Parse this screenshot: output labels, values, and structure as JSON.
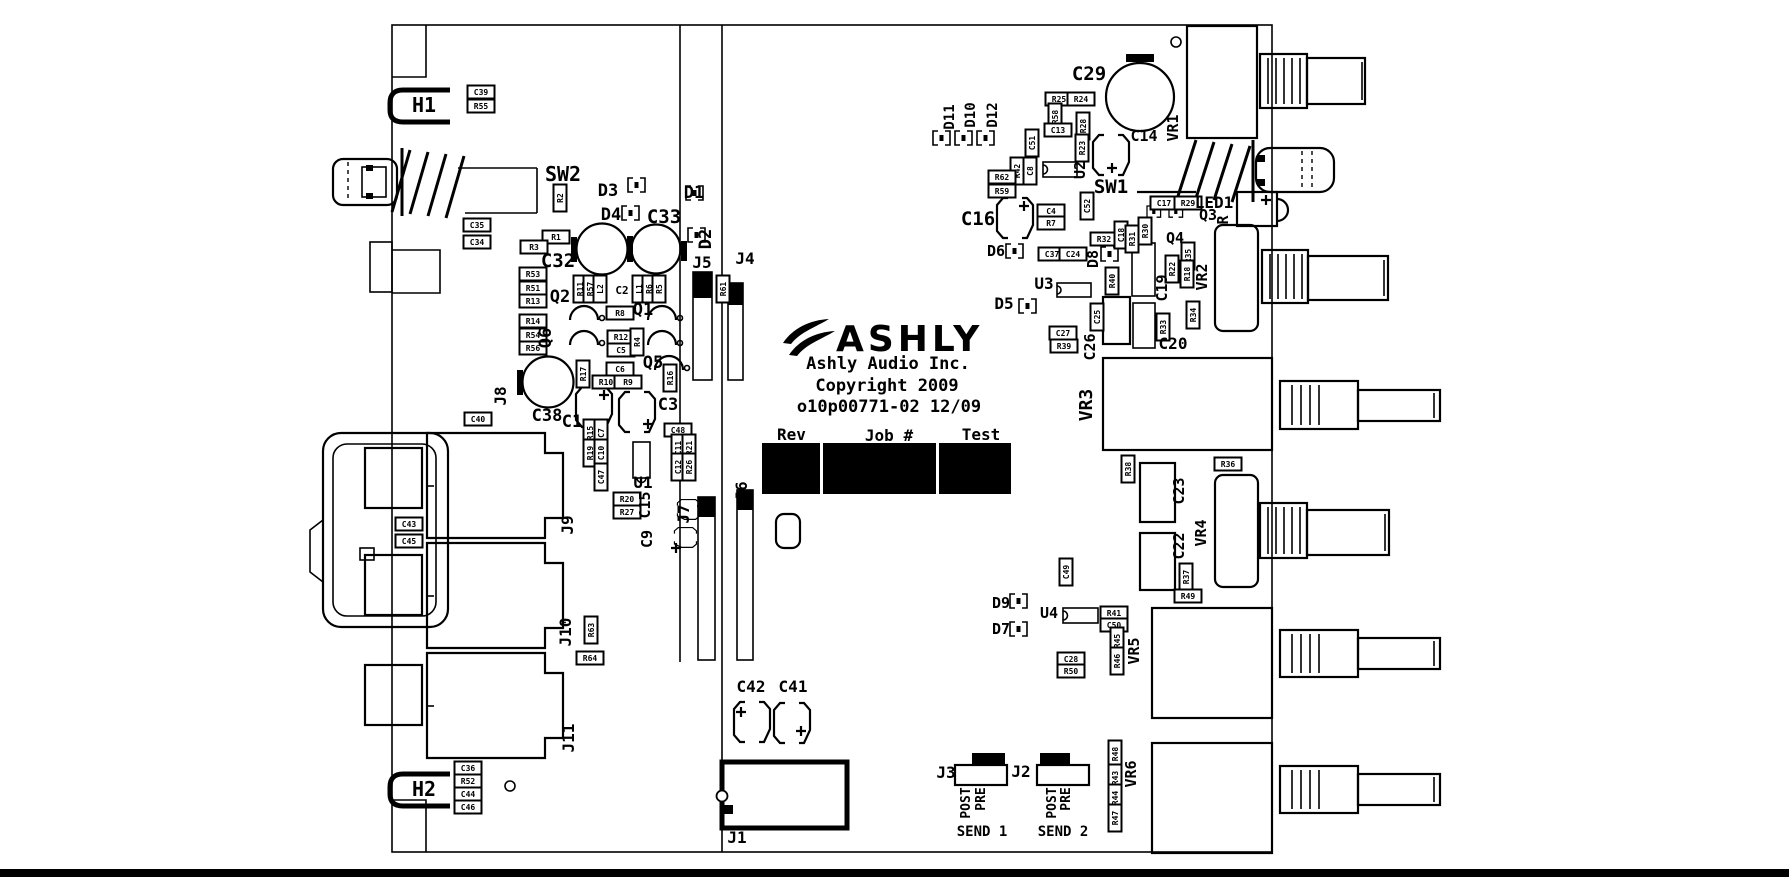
{
  "logo": {
    "brand": "ASHLY",
    "company": "Ashly Audio Inc.",
    "copyright": "Copyright 2009",
    "part_number": "o10p00771-02 12/09"
  },
  "fields": {
    "rev": "Rev",
    "job": "Job #",
    "test": "Test"
  },
  "colors": {
    "silkscreen": "#000000",
    "background": "#ffffff"
  },
  "labels": [
    {
      "t": "H1",
      "x": 424,
      "y": 112,
      "s": 20
    },
    {
      "t": "SW2",
      "x": 563,
      "y": 181,
      "s": 20
    },
    {
      "t": "D3",
      "x": 608,
      "y": 196,
      "s": 17
    },
    {
      "t": "D4",
      "x": 611,
      "y": 220,
      "s": 17
    },
    {
      "t": "C33",
      "x": 664,
      "y": 223,
      "s": 19
    },
    {
      "t": "D1",
      "x": 694,
      "y": 198,
      "s": 17
    },
    {
      "t": "D2",
      "x": 711,
      "y": 239,
      "r": 1,
      "s": 17
    },
    {
      "t": "C32",
      "x": 558,
      "y": 267,
      "s": 19
    },
    {
      "t": "J5",
      "x": 702,
      "y": 268
    },
    {
      "t": "J4",
      "x": 745,
      "y": 264
    },
    {
      "t": "Q2",
      "x": 560,
      "y": 302,
      "s": 17
    },
    {
      "t": "C2",
      "x": 622,
      "y": 294,
      "s": 11
    },
    {
      "t": "Q1",
      "x": 643,
      "y": 315,
      "s": 17
    },
    {
      "t": "Q6",
      "x": 551,
      "y": 338,
      "r": 1,
      "s": 17
    },
    {
      "t": "Q5",
      "x": 653,
      "y": 368,
      "s": 17
    },
    {
      "t": "J8",
      "x": 506,
      "y": 396,
      "r": 1
    },
    {
      "t": "C38",
      "x": 547,
      "y": 421,
      "s": 17
    },
    {
      "t": "C1",
      "x": 572,
      "y": 427,
      "s": 17
    },
    {
      "t": "C3",
      "x": 668,
      "y": 410,
      "s": 17
    },
    {
      "t": "U1",
      "x": 643,
      "y": 488
    },
    {
      "t": "C15",
      "x": 650,
      "y": 505,
      "r": 1,
      "s": 15
    },
    {
      "t": "C9",
      "x": 652,
      "y": 539,
      "r": 1,
      "s": 15
    },
    {
      "t": "J7",
      "x": 689,
      "y": 514,
      "r": 1
    },
    {
      "t": "J6",
      "x": 747,
      "y": 491,
      "r": 1
    },
    {
      "t": "J9",
      "x": 573,
      "y": 525,
      "r": 1
    },
    {
      "t": "J10",
      "x": 571,
      "y": 632,
      "r": 1
    },
    {
      "t": "J11",
      "x": 574,
      "y": 738,
      "r": 1
    },
    {
      "t": "H2",
      "x": 424,
      "y": 796,
      "s": 20
    },
    {
      "t": "C42",
      "x": 751,
      "y": 692
    },
    {
      "t": "C41",
      "x": 793,
      "y": 692
    },
    {
      "t": "J1",
      "x": 737,
      "y": 843
    },
    {
      "t": "D11",
      "x": 954,
      "y": 117,
      "r": 1,
      "s": 14
    },
    {
      "t": "D10",
      "x": 975,
      "y": 115,
      "r": 1,
      "s": 14
    },
    {
      "t": "D12",
      "x": 997,
      "y": 115,
      "r": 1,
      "s": 14
    },
    {
      "t": "C29",
      "x": 1089,
      "y": 80,
      "s": 19
    },
    {
      "t": "VR1",
      "x": 1178,
      "y": 128,
      "r": 1,
      "s": 15
    },
    {
      "t": "C14",
      "x": 1144,
      "y": 141,
      "s": 15
    },
    {
      "t": "U2",
      "x": 1085,
      "y": 170,
      "r": 1,
      "s": 15
    },
    {
      "t": "SW1",
      "x": 1111,
      "y": 193,
      "s": 19
    },
    {
      "t": "C16",
      "x": 978,
      "y": 225,
      "s": 19
    },
    {
      "t": "LED1",
      "x": 1214,
      "y": 208
    },
    {
      "t": "Q3",
      "x": 1208,
      "y": 220,
      "s": 15
    },
    {
      "t": "R",
      "x": 1228,
      "y": 220,
      "r": 1,
      "s": 15
    },
    {
      "t": "Q4",
      "x": 1175,
      "y": 243,
      "s": 15
    },
    {
      "t": "VR2",
      "x": 1207,
      "y": 277,
      "r": 1,
      "s": 15
    },
    {
      "t": "D8",
      "x": 1098,
      "y": 259,
      "r": 1,
      "s": 15
    },
    {
      "t": "D6",
      "x": 996,
      "y": 256,
      "s": 15
    },
    {
      "t": "U3",
      "x": 1044,
      "y": 289
    },
    {
      "t": "D5",
      "x": 1004,
      "y": 309
    },
    {
      "t": "C26",
      "x": 1095,
      "y": 347,
      "r": 1,
      "s": 15
    },
    {
      "t": "C19",
      "x": 1167,
      "y": 288,
      "r": 1,
      "s": 15
    },
    {
      "t": "C20",
      "x": 1173,
      "y": 349
    },
    {
      "t": "VR3",
      "x": 1092,
      "y": 405,
      "r": 1,
      "s": 18
    },
    {
      "t": "C23",
      "x": 1184,
      "y": 491,
      "r": 1,
      "s": 15
    },
    {
      "t": "C22",
      "x": 1184,
      "y": 546,
      "r": 1,
      "s": 15
    },
    {
      "t": "VR4",
      "x": 1206,
      "y": 533,
      "r": 1,
      "s": 15
    },
    {
      "t": "D9",
      "x": 1001,
      "y": 608,
      "s": 15
    },
    {
      "t": "D7",
      "x": 1001,
      "y": 634,
      "s": 15
    },
    {
      "t": "U4",
      "x": 1049,
      "y": 618,
      "s": 15
    },
    {
      "t": "VR5",
      "x": 1139,
      "y": 651,
      "r": 1,
      "s": 15
    },
    {
      "t": "J3",
      "x": 946,
      "y": 778
    },
    {
      "t": "J2",
      "x": 1021,
      "y": 777
    },
    {
      "t": "VR6",
      "x": 1136,
      "y": 774,
      "r": 1,
      "s": 15
    },
    {
      "t": "POST",
      "x": 970,
      "y": 803,
      "r": 1,
      "s": 13
    },
    {
      "t": "PRE",
      "x": 985,
      "y": 799,
      "r": 1,
      "s": 13
    },
    {
      "t": "POST",
      "x": 1056,
      "y": 803,
      "r": 1,
      "s": 13
    },
    {
      "t": "PRE",
      "x": 1070,
      "y": 799,
      "r": 1,
      "s": 13
    },
    {
      "t": "SEND 1",
      "x": 982,
      "y": 836,
      "s": 14
    },
    {
      "t": "SEND 2",
      "x": 1063,
      "y": 836,
      "s": 14
    }
  ],
  "smd_labels": [
    {
      "t": "C39",
      "x": 481,
      "y": 92
    },
    {
      "t": "R55",
      "x": 481,
      "y": 106
    },
    {
      "t": "C35",
      "x": 477,
      "y": 225
    },
    {
      "t": "C34",
      "x": 477,
      "y": 242
    },
    {
      "t": "R2",
      "x": 560,
      "y": 198,
      "r": 1
    },
    {
      "t": "R1",
      "x": 556,
      "y": 237
    },
    {
      "t": "R3",
      "x": 534,
      "y": 247
    },
    {
      "t": "R53",
      "x": 533,
      "y": 274
    },
    {
      "t": "R51",
      "x": 533,
      "y": 288
    },
    {
      "t": "R13",
      "x": 533,
      "y": 301
    },
    {
      "t": "R14",
      "x": 533,
      "y": 321
    },
    {
      "t": "R54",
      "x": 533,
      "y": 335
    },
    {
      "t": "R56",
      "x": 533,
      "y": 348
    },
    {
      "t": "R11",
      "x": 580,
      "y": 289,
      "r": 1
    },
    {
      "t": "R57",
      "x": 590,
      "y": 289,
      "r": 1
    },
    {
      "t": "L2",
      "x": 600,
      "y": 289,
      "r": 1
    },
    {
      "t": "L1",
      "x": 639,
      "y": 289,
      "r": 1
    },
    {
      "t": "R6",
      "x": 649,
      "y": 289,
      "r": 1
    },
    {
      "t": "R5",
      "x": 659,
      "y": 289,
      "r": 1
    },
    {
      "t": "R61",
      "x": 723,
      "y": 289,
      "r": 1
    },
    {
      "t": "R8",
      "x": 620,
      "y": 313
    },
    {
      "t": "R12",
      "x": 621,
      "y": 337
    },
    {
      "t": "C5",
      "x": 621,
      "y": 350
    },
    {
      "t": "R4",
      "x": 637,
      "y": 342,
      "r": 1
    },
    {
      "t": "C6",
      "x": 620,
      "y": 369
    },
    {
      "t": "R10",
      "x": 606,
      "y": 382
    },
    {
      "t": "R9",
      "x": 628,
      "y": 382
    },
    {
      "t": "R17",
      "x": 583,
      "y": 374,
      "r": 1
    },
    {
      "t": "R16",
      "x": 670,
      "y": 378,
      "r": 1
    },
    {
      "t": "C40",
      "x": 478,
      "y": 419
    },
    {
      "t": "R15",
      "x": 590,
      "y": 433,
      "r": 1
    },
    {
      "t": "C7",
      "x": 601,
      "y": 433,
      "r": 1
    },
    {
      "t": "R19",
      "x": 590,
      "y": 453,
      "r": 1
    },
    {
      "t": "C10",
      "x": 601,
      "y": 453,
      "r": 1
    },
    {
      "t": "C47",
      "x": 601,
      "y": 477,
      "r": 1
    },
    {
      "t": "C48",
      "x": 678,
      "y": 430
    },
    {
      "t": "C11",
      "x": 678,
      "y": 448,
      "r": 1
    },
    {
      "t": "R21",
      "x": 689,
      "y": 448,
      "r": 1
    },
    {
      "t": "C12",
      "x": 678,
      "y": 467,
      "r": 1
    },
    {
      "t": "R26",
      "x": 689,
      "y": 467,
      "r": 1
    },
    {
      "t": "R20",
      "x": 627,
      "y": 499
    },
    {
      "t": "R27",
      "x": 627,
      "y": 512
    },
    {
      "t": "C43",
      "x": 409,
      "y": 524
    },
    {
      "t": "C45",
      "x": 409,
      "y": 541
    },
    {
      "t": "R63",
      "x": 591,
      "y": 630,
      "r": 1
    },
    {
      "t": "R64",
      "x": 590,
      "y": 658
    },
    {
      "t": "C36",
      "x": 468,
      "y": 768
    },
    {
      "t": "R52",
      "x": 468,
      "y": 781
    },
    {
      "t": "C44",
      "x": 468,
      "y": 794
    },
    {
      "t": "C46",
      "x": 468,
      "y": 807
    },
    {
      "t": "R25",
      "x": 1059,
      "y": 99
    },
    {
      "t": "R24",
      "x": 1081,
      "y": 99
    },
    {
      "t": "R58",
      "x": 1055,
      "y": 117,
      "r": 1
    },
    {
      "t": "C13",
      "x": 1058,
      "y": 130
    },
    {
      "t": "R28",
      "x": 1083,
      "y": 126,
      "r": 1
    },
    {
      "t": "R23",
      "x": 1082,
      "y": 148,
      "r": 1
    },
    {
      "t": "C51",
      "x": 1032,
      "y": 143,
      "r": 1
    },
    {
      "t": "R42",
      "x": 1017,
      "y": 171,
      "r": 1
    },
    {
      "t": "C8",
      "x": 1030,
      "y": 171,
      "r": 1
    },
    {
      "t": "R62",
      "x": 1002,
      "y": 177
    },
    {
      "t": "R59",
      "x": 1002,
      "y": 191
    },
    {
      "t": "C52",
      "x": 1087,
      "y": 206,
      "r": 1
    },
    {
      "t": "C4",
      "x": 1051,
      "y": 211
    },
    {
      "t": "R7",
      "x": 1051,
      "y": 223
    },
    {
      "t": "C17",
      "x": 1164,
      "y": 203
    },
    {
      "t": "R29",
      "x": 1188,
      "y": 203
    },
    {
      "t": "R32",
      "x": 1104,
      "y": 239
    },
    {
      "t": "C18",
      "x": 1121,
      "y": 235,
      "r": 1
    },
    {
      "t": "R31",
      "x": 1132,
      "y": 239,
      "r": 1
    },
    {
      "t": "R30",
      "x": 1145,
      "y": 231,
      "r": 1
    },
    {
      "t": "C37",
      "x": 1052,
      "y": 254
    },
    {
      "t": "C24",
      "x": 1073,
      "y": 254
    },
    {
      "t": "R22",
      "x": 1172,
      "y": 269,
      "r": 1
    },
    {
      "t": "R35",
      "x": 1188,
      "y": 256,
      "r": 1
    },
    {
      "t": "R18",
      "x": 1187,
      "y": 274,
      "r": 1
    },
    {
      "t": "R40",
      "x": 1112,
      "y": 281,
      "r": 1
    },
    {
      "t": "C25",
      "x": 1097,
      "y": 317,
      "r": 1
    },
    {
      "t": "C27",
      "x": 1063,
      "y": 333
    },
    {
      "t": "R39",
      "x": 1064,
      "y": 346
    },
    {
      "t": "R33",
      "x": 1163,
      "y": 327,
      "r": 1
    },
    {
      "t": "R34",
      "x": 1193,
      "y": 315,
      "r": 1
    },
    {
      "t": "R38",
      "x": 1128,
      "y": 469,
      "r": 1
    },
    {
      "t": "R36",
      "x": 1228,
      "y": 464
    },
    {
      "t": "R37",
      "x": 1186,
      "y": 577,
      "r": 1
    },
    {
      "t": "R49",
      "x": 1188,
      "y": 596
    },
    {
      "t": "C49",
      "x": 1066,
      "y": 572,
      "r": 1
    },
    {
      "t": "R41",
      "x": 1114,
      "y": 613
    },
    {
      "t": "C50",
      "x": 1114,
      "y": 625
    },
    {
      "t": "R45",
      "x": 1117,
      "y": 641,
      "r": 1
    },
    {
      "t": "R46",
      "x": 1117,
      "y": 661,
      "r": 1
    },
    {
      "t": "C28",
      "x": 1071,
      "y": 659
    },
    {
      "t": "R50",
      "x": 1071,
      "y": 671
    },
    {
      "t": "R48",
      "x": 1115,
      "y": 754,
      "r": 1
    },
    {
      "t": "R43",
      "x": 1115,
      "y": 778,
      "r": 1
    },
    {
      "t": "R44",
      "x": 1115,
      "y": 798,
      "r": 1
    },
    {
      "t": "R47",
      "x": 1115,
      "y": 818,
      "r": 1
    }
  ]
}
